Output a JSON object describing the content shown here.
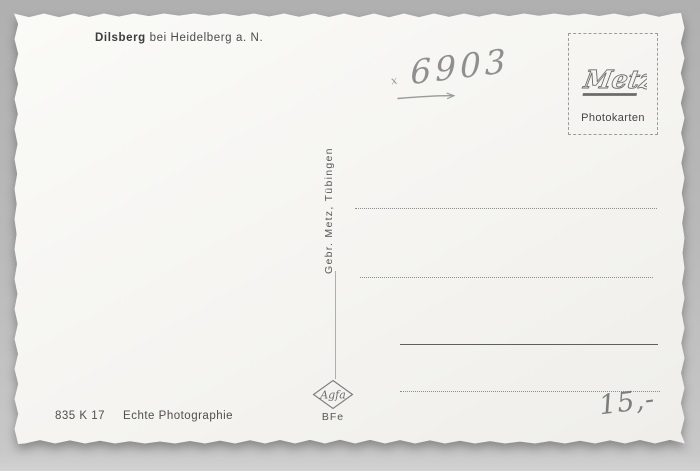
{
  "caption": {
    "place": "Dilsberg",
    "suffix": "bei Heidelberg a. N."
  },
  "handwriting": {
    "number": "6903",
    "mark": "x",
    "price": "15,-"
  },
  "publisher_box": {
    "logo": "Metz",
    "label": "Photokarten"
  },
  "spine": {
    "publisher": "Gebr. Metz, Tübingen"
  },
  "film_brand": {
    "logo": "Agfa",
    "code": "BFe"
  },
  "footer": {
    "order_code": "835 K 17",
    "label": "Echte Photographie"
  },
  "colors": {
    "background": "#b9b9b9",
    "card": "#f5f4f1",
    "printed_ink": "#4a4a4a",
    "pencil": "#8f8f8f",
    "rule_line": "#8d8d8d"
  }
}
